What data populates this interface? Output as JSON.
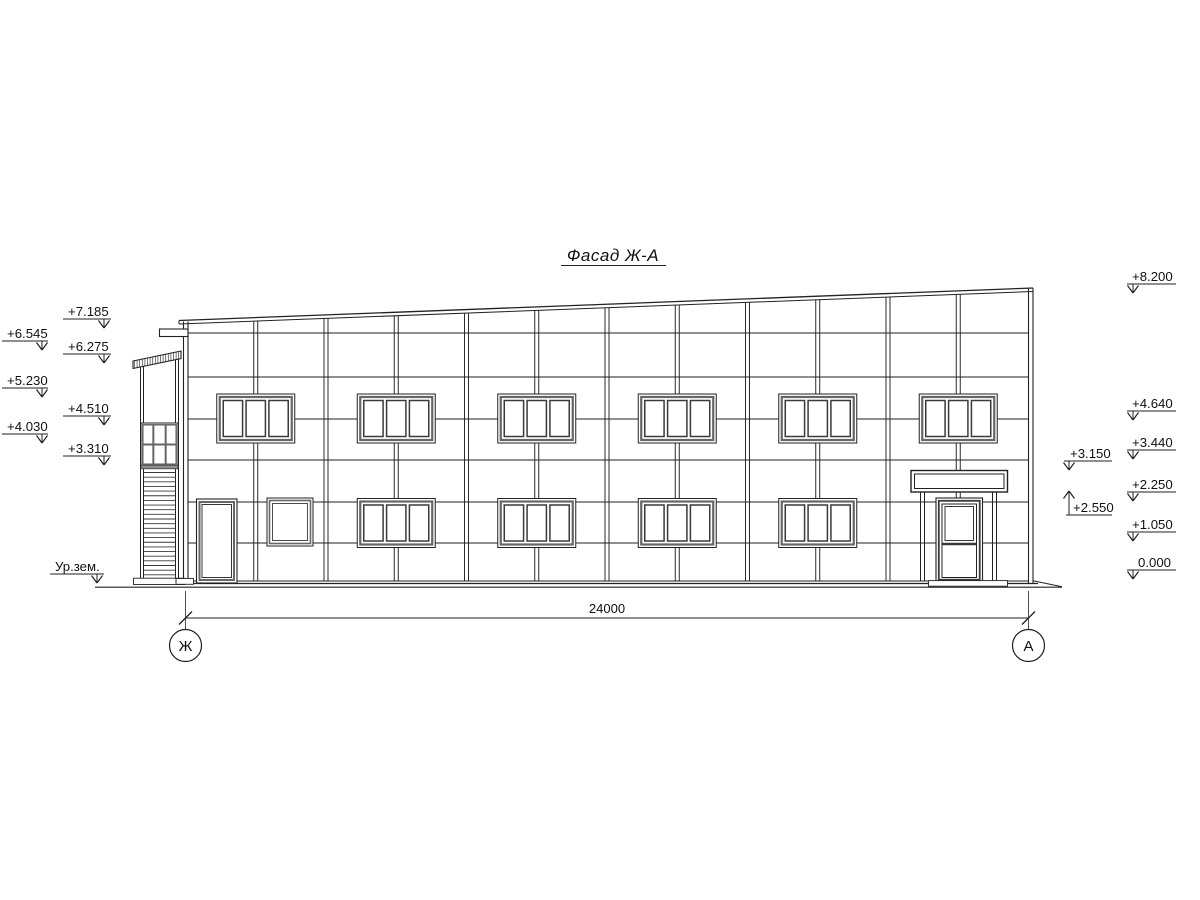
{
  "title": {
    "text": "Фасад Ж-А"
  },
  "dimension": {
    "value": "24000"
  },
  "axis_bubbles": [
    {
      "label": "Ж"
    },
    {
      "label": "А"
    }
  ],
  "colors": {
    "ink": "#222222",
    "frame": "#666666",
    "mid": "#3a3a3a",
    "band": "#8f8f8f"
  },
  "elevation_marks": [
    {
      "label": "+6.545",
      "text_x": 7,
      "text_y": 338,
      "line_x1": 2,
      "line_x2": 48,
      "line_y": 341,
      "arrow_x": 42,
      "tip_y": 350,
      "dir": "down"
    },
    {
      "label": "+5.230",
      "text_x": 7,
      "text_y": 385,
      "line_x1": 2,
      "line_x2": 48,
      "line_y": 388,
      "arrow_x": 42,
      "tip_y": 397,
      "dir": "down"
    },
    {
      "label": "+4.030",
      "text_x": 7,
      "text_y": 431,
      "line_x1": 2,
      "line_x2": 48,
      "line_y": 434,
      "arrow_x": 42,
      "tip_y": 443,
      "dir": "down"
    },
    {
      "label": "Ур.зем.",
      "text_x": 55,
      "text_y": 571,
      "line_x1": 50,
      "line_x2": 104,
      "line_y": 574,
      "arrow_x": 97,
      "tip_y": 583,
      "dir": "down"
    },
    {
      "label": "+7.185",
      "text_x": 68,
      "text_y": 316,
      "line_x1": 63,
      "line_x2": 111,
      "line_y": 319,
      "arrow_x": 104,
      "tip_y": 328,
      "dir": "down"
    },
    {
      "label": "+6.275",
      "text_x": 68,
      "text_y": 351,
      "line_x1": 63,
      "line_x2": 111,
      "line_y": 354,
      "arrow_x": 104,
      "tip_y": 363,
      "dir": "down"
    },
    {
      "label": "+4.510",
      "text_x": 68,
      "text_y": 413,
      "line_x1": 63,
      "line_x2": 111,
      "line_y": 416,
      "arrow_x": 104,
      "tip_y": 425,
      "dir": "down"
    },
    {
      "label": "+3.310",
      "text_x": 68,
      "text_y": 453,
      "line_x1": 63,
      "line_x2": 111,
      "line_y": 456,
      "arrow_x": 104,
      "tip_y": 465,
      "dir": "down"
    },
    {
      "label": "+8.200",
      "text_x": 1132,
      "text_y": 281,
      "line_x1": 1127,
      "line_x2": 1176,
      "line_y": 284,
      "arrow_x": 1133,
      "tip_y": 293,
      "dir": "down"
    },
    {
      "label": "+4.640",
      "text_x": 1132,
      "text_y": 408,
      "line_x1": 1127,
      "line_x2": 1176,
      "line_y": 411,
      "arrow_x": 1133,
      "tip_y": 420,
      "dir": "down"
    },
    {
      "label": "+3.440",
      "text_x": 1132,
      "text_y": 447,
      "line_x1": 1127,
      "line_x2": 1176,
      "line_y": 450,
      "arrow_x": 1133,
      "tip_y": 459,
      "dir": "down"
    },
    {
      "label": "+2.250",
      "text_x": 1132,
      "text_y": 489,
      "line_x1": 1127,
      "line_x2": 1176,
      "line_y": 492,
      "arrow_x": 1133,
      "tip_y": 501,
      "dir": "down"
    },
    {
      "label": "+1.050",
      "text_x": 1132,
      "text_y": 529,
      "line_x1": 1127,
      "line_x2": 1176,
      "line_y": 532,
      "arrow_x": 1133,
      "tip_y": 541,
      "dir": "down"
    },
    {
      "label": "0.000",
      "text_x": 1138,
      "text_y": 567,
      "line_x1": 1127,
      "line_x2": 1176,
      "line_y": 570,
      "arrow_x": 1133,
      "tip_y": 579,
      "dir": "down"
    },
    {
      "label": "+3.150",
      "text_x": 1070,
      "text_y": 458,
      "line_x1": 1064,
      "line_x2": 1112,
      "line_y": 461,
      "arrow_x": 1069,
      "tip_y": 470,
      "dir": "down"
    },
    {
      "label": "+2.550",
      "text_x": 1073,
      "text_y": 512,
      "line_x1": 1066,
      "line_x2": 1112,
      "line_y": 515,
      "arrow_x": 1069,
      "tip_y": 491,
      "dir": "up"
    }
  ],
  "facade": {
    "left_wall": [
      183.5,
      188
    ],
    "right_wall": [
      1028.5,
      1033
    ],
    "base_y": 583.5,
    "plinth_y": 581,
    "parapet": {
      "x1": 179,
      "y1": 320.5,
      "x2": 1033,
      "y2": 288,
      "band": 3.5
    },
    "joints": [
      333,
      377,
      419,
      460,
      502,
      543
    ],
    "mullions": {
      "start": 185.5,
      "step": 70.25,
      "count": 11,
      "half_w": 2
    },
    "upper_window_centers": [
      255.75,
      396.25,
      536.75,
      677.25,
      817.75,
      958.25
    ],
    "lower_window_centers": [
      396.25,
      536.75,
      677.25,
      817.75
    ],
    "window": {
      "w": 78,
      "h": 49,
      "upper_y": 394,
      "lower_y": 498.5
    },
    "service_door": {
      "x": 196.5,
      "y": 499,
      "w": 40.5,
      "h": 84
    },
    "small_window": {
      "x": 267,
      "y": 498,
      "w": 46,
      "h": 48
    },
    "entrance": {
      "canopy": {
        "x": 911,
        "y": 470.5,
        "w": 96.5,
        "h": 21.5
      },
      "posts": [
        922.5,
        994.5
      ],
      "post_top": 492,
      "post_bottom": 581,
      "door": {
        "x": 936,
        "y": 498,
        "w": 46.5,
        "h": 84.5,
        "rail_y": 544
      },
      "threshold": {
        "x": 928.5,
        "y": 580.6,
        "w": 79,
        "h": 5.6
      }
    },
    "tower": {
      "left_edge": [
        140.5,
        143.5
      ],
      "right_edge": [
        175.5,
        178.5
      ],
      "left_top": 366.5,
      "right_top": 359.5,
      "bottom": 578.5,
      "roof": {
        "x1": 133,
        "x2": 181,
        "top1": 361,
        "top2": 351,
        "th": 7.5
      },
      "window": {
        "x": 141,
        "y": 423,
        "w": 37,
        "h": 43,
        "rail_y": 444.5
      },
      "band": {
        "x": 141,
        "y": 465.2,
        "w": 37,
        "h": 3.6
      },
      "stairs": {
        "x1": 143.5,
        "x2": 175.5,
        "y1": 472.5,
        "step": 4.65,
        "n": 23
      },
      "footing": {
        "x": 133.5,
        "y": 578.2,
        "w": 51,
        "h": 6.3
      }
    },
    "ledge": {
      "x": 159.5,
      "y": 329,
      "w": 28.5,
      "h": 7.5
    },
    "left_footing": {
      "x": 176,
      "y": 578.5,
      "w": 17.5,
      "h": 5.8
    },
    "grade_wedge": {
      "x1": 1033,
      "y1": 580.8,
      "x2": 1062,
      "y2": 586.8
    },
    "ground": {
      "y": 587.2,
      "x1": 95,
      "x2": 1062
    },
    "dim": {
      "y": 618,
      "x1": 185.5,
      "x2": 1028.5,
      "ext_y1": 591,
      "ext_y2": 630,
      "tick": 6.5
    },
    "axis": {
      "cy": 645.5,
      "r": 16
    }
  }
}
